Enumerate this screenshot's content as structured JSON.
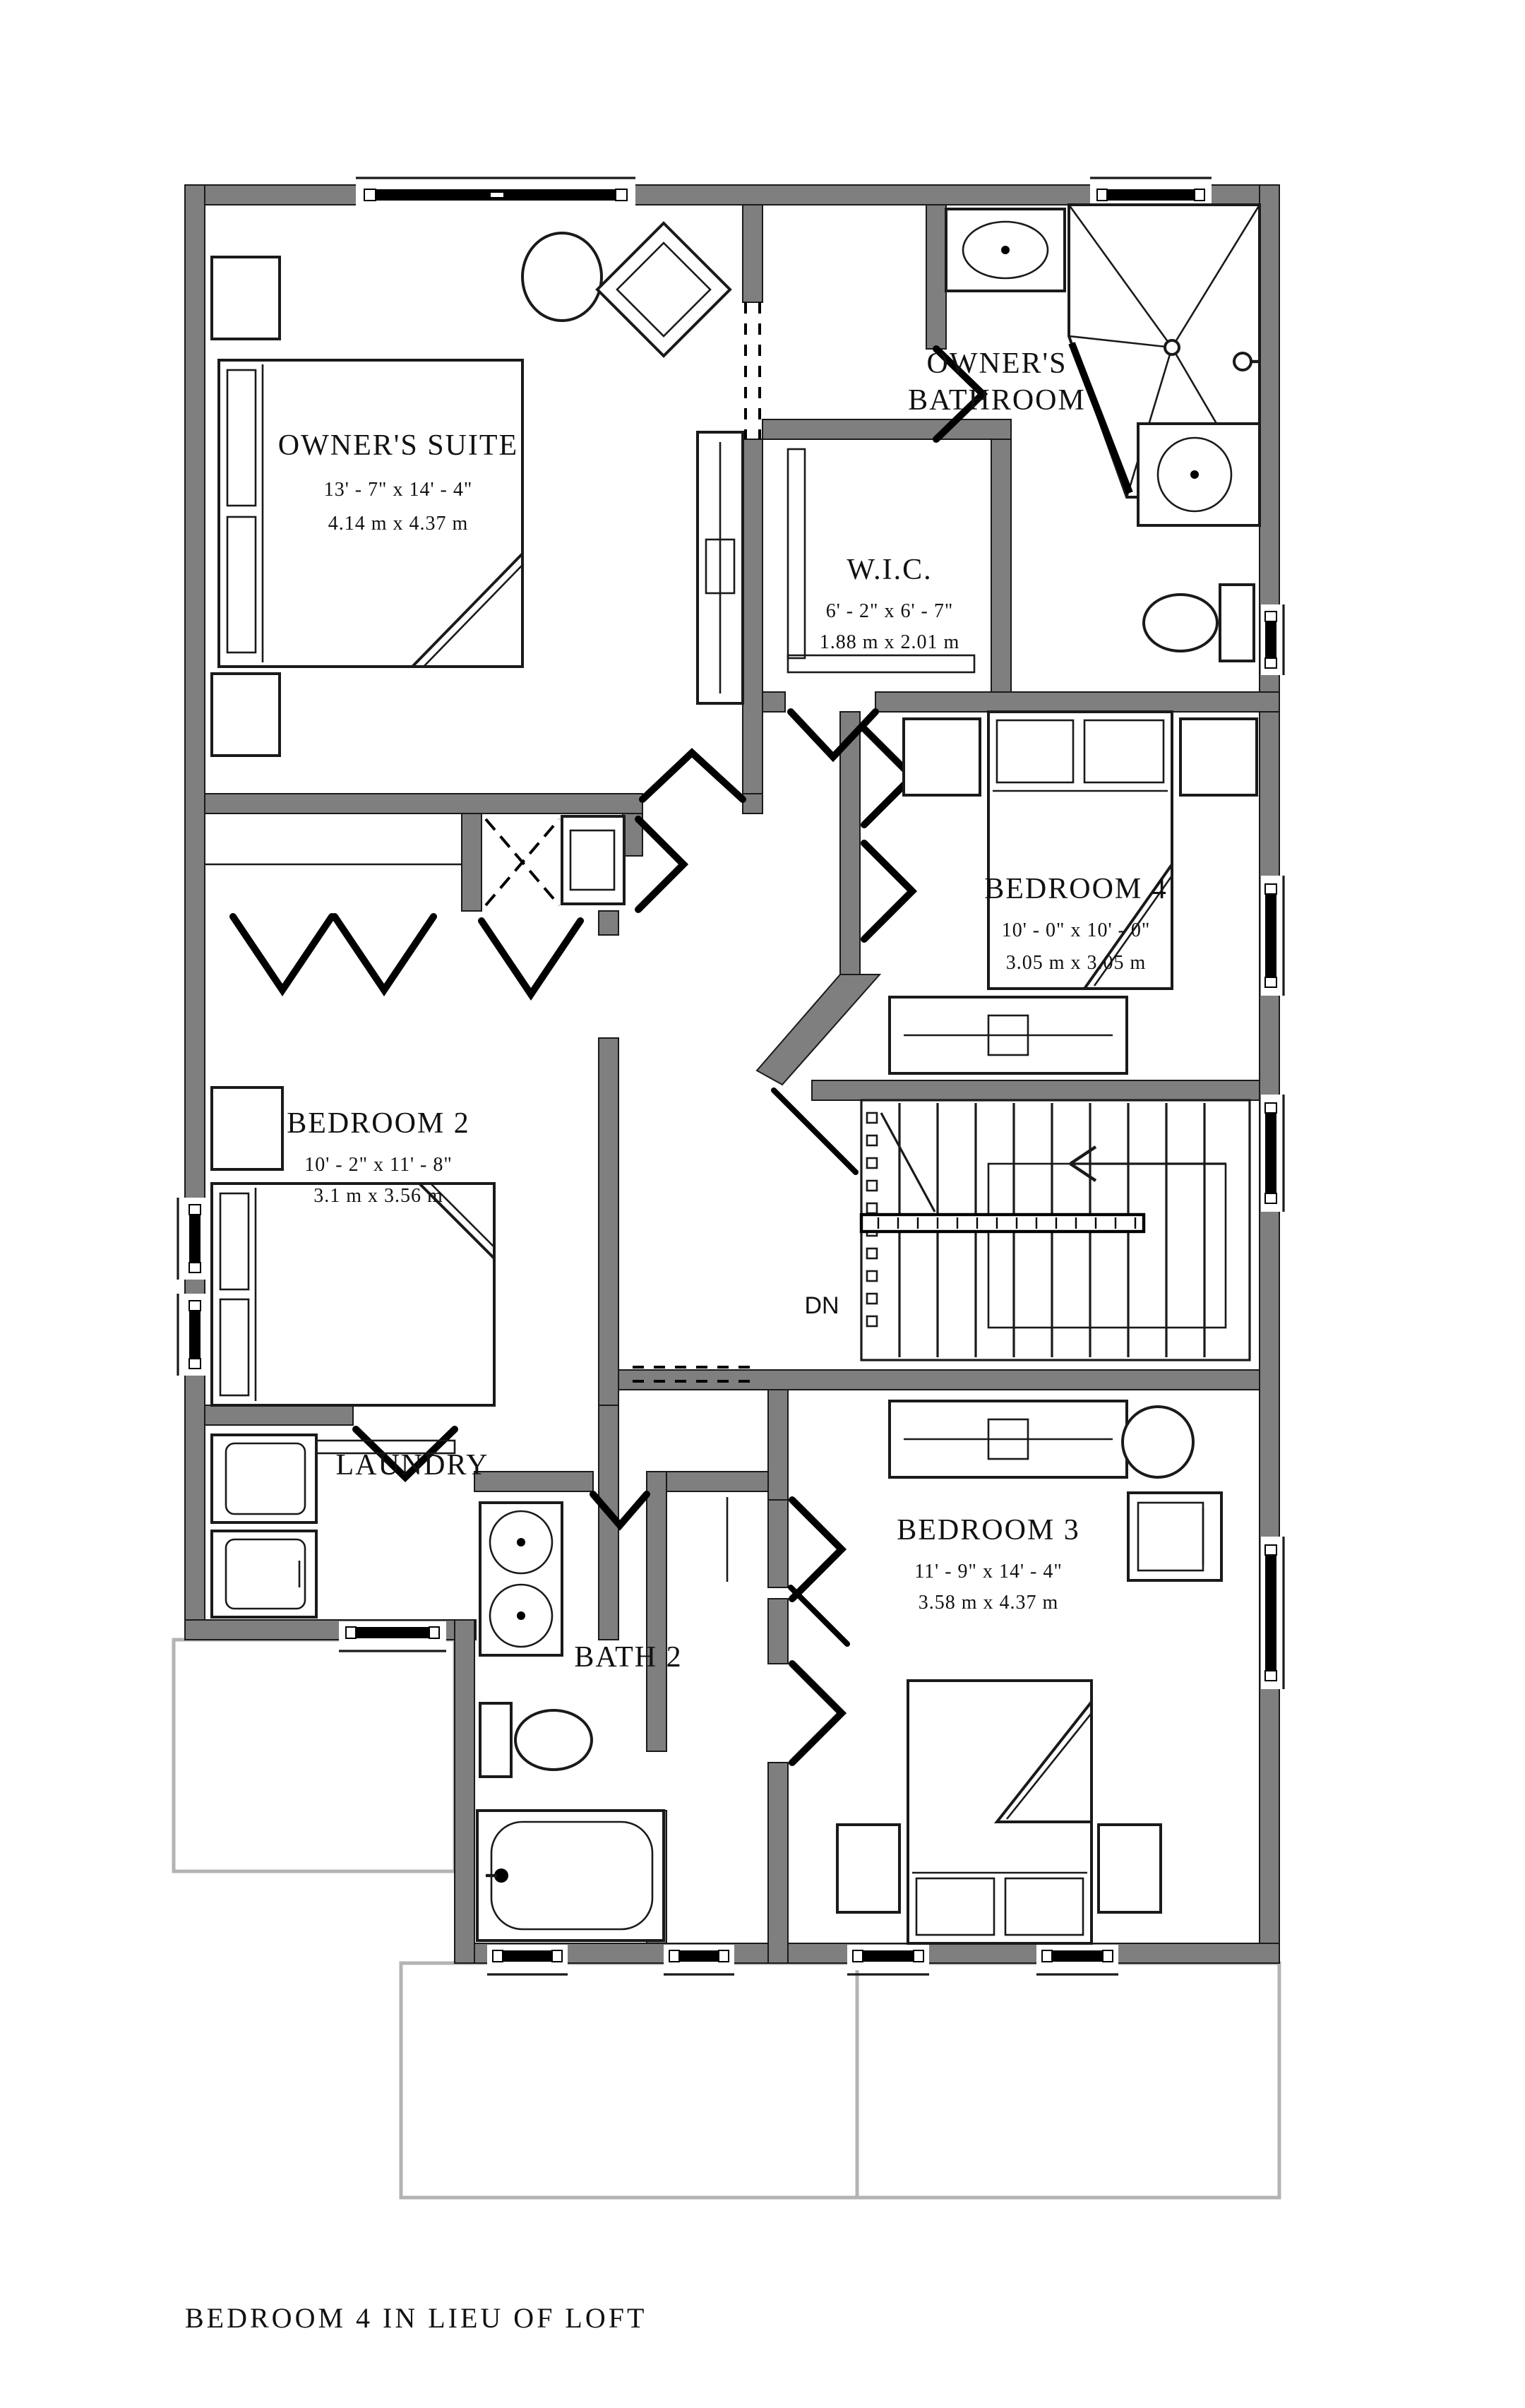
{
  "plan": {
    "caption": "BEDROOM 4 IN LIEU OF LOFT",
    "stairs": {
      "direction_label": "DN"
    },
    "rooms": {
      "owners_suite": {
        "name": "OWNER'S SUITE",
        "dim_imperial": "13' - 7\" x 14' - 4\"",
        "dim_metric": "4.14 m x 4.37 m"
      },
      "owners_bathroom": {
        "name_line1": "OWNER'S",
        "name_line2": "BATHROOM"
      },
      "wic": {
        "name": "W.I.C.",
        "dim_imperial": "6' - 2\" x 6' - 7\"",
        "dim_metric": "1.88 m x 2.01 m"
      },
      "bedroom4": {
        "name": "BEDROOM 4",
        "dim_imperial": "10' - 0\" x 10' - 0\"",
        "dim_metric": "3.05 m x 3.05 m"
      },
      "bedroom2": {
        "name": "BEDROOM 2",
        "dim_imperial": "10' - 2\" x 11' - 8\"",
        "dim_metric": "3.1 m x 3.56 m"
      },
      "bedroom3": {
        "name": "BEDROOM 3",
        "dim_imperial": "11' - 9\" x 14' - 4\"",
        "dim_metric": "3.58 m x 4.37 m"
      },
      "laundry": {
        "name": "LAUNDRY"
      },
      "bath2": {
        "name": "BATH 2"
      }
    },
    "colors": {
      "wall": "#7f7f7f",
      "line": "#1a1a1a",
      "porch": "#b3b3b3",
      "background": "#ffffff"
    }
  }
}
